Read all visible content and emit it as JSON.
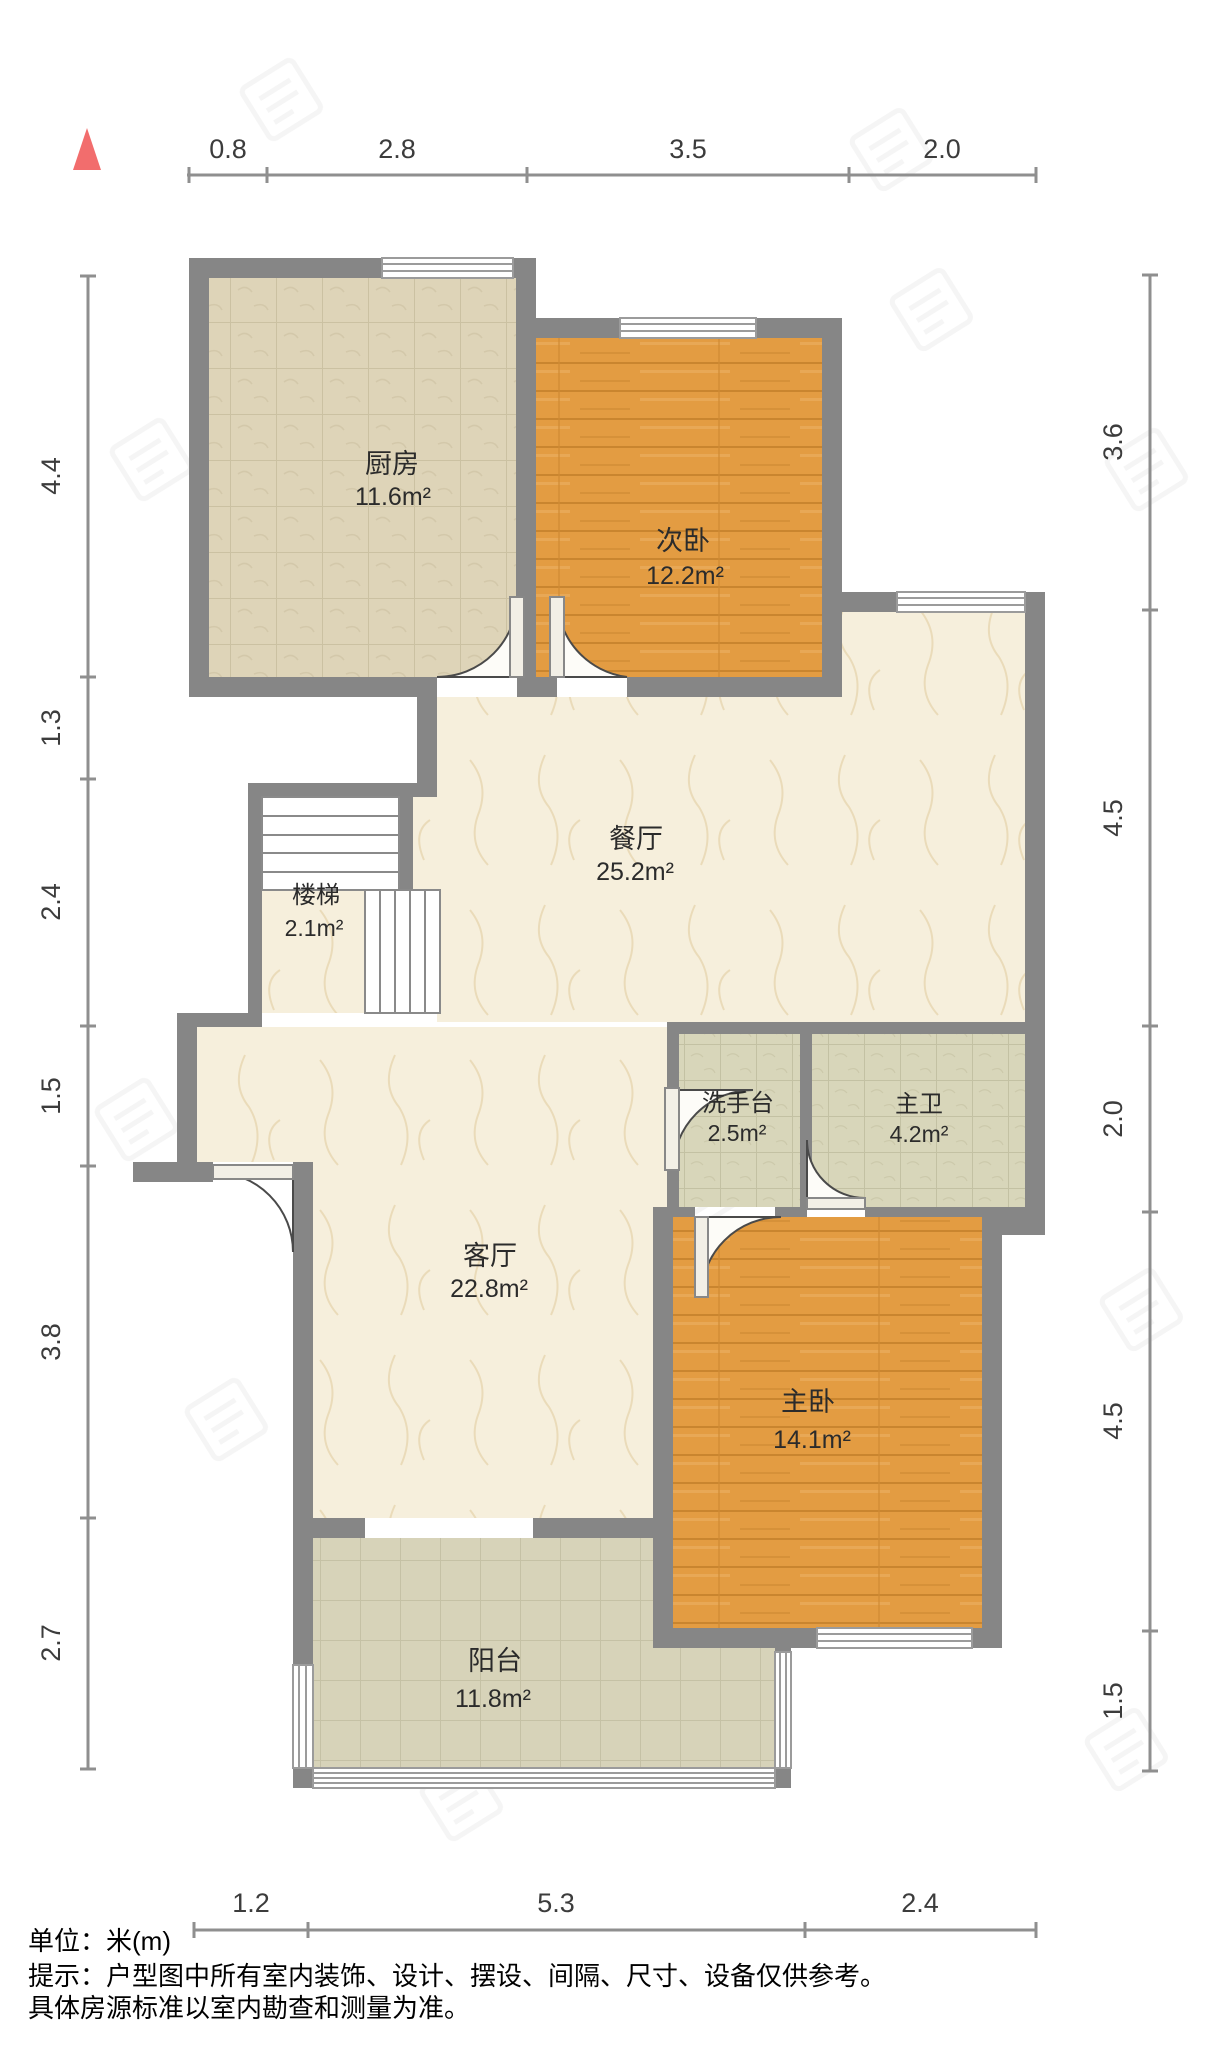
{
  "title": "户型图",
  "unit_note": "单位：米(m)",
  "north_indicator": "north-arrow",
  "rooms": [
    {
      "id": "kitchen",
      "name": "厨房",
      "area": "11.6m²"
    },
    {
      "id": "secondary-bedroom",
      "name": "次卧",
      "area": "12.2m²"
    },
    {
      "id": "dining-room",
      "name": "餐厅",
      "area": "25.2m²"
    },
    {
      "id": "stairs",
      "name": "楼梯",
      "area": "2.1m²"
    },
    {
      "id": "wash-basin",
      "name": "洗手台",
      "area": "2.5m²"
    },
    {
      "id": "master-bath",
      "name": "主卫",
      "area": "4.2m²"
    },
    {
      "id": "living-room",
      "name": "客厅",
      "area": "22.8m²"
    },
    {
      "id": "master-bedroom",
      "name": "主卧",
      "area": "14.1m²"
    },
    {
      "id": "balcony",
      "name": "阳台",
      "area": "11.8m²"
    }
  ],
  "dimensions": {
    "top": [
      "0.8",
      "2.8",
      "3.5",
      "2.0"
    ],
    "left": [
      "4.4",
      "1.3",
      "2.4",
      "1.5",
      "3.8",
      "2.7"
    ],
    "right": [
      "3.6",
      "4.5",
      "2.0",
      "4.5",
      "1.5"
    ],
    "bottom": [
      "1.2",
      "5.3",
      "2.4"
    ]
  },
  "footer": {
    "line1": "单位：米(m)",
    "line2": "提示：户型图中所有室内装饰、设计、摆设、间隔、尺寸、设备仅供参考。",
    "line3": "具体房源标准以室内勘查和测量为准。"
  },
  "colors": {
    "north_arrow": "#f26d6d",
    "walls": "#868686",
    "wood_floor": "#e39c42",
    "tile_floor": "#ded4b8",
    "marble_floor": "#f6efdc",
    "bath_tile": "#d8d6ba",
    "dimension_line": "#8f8f8f"
  }
}
